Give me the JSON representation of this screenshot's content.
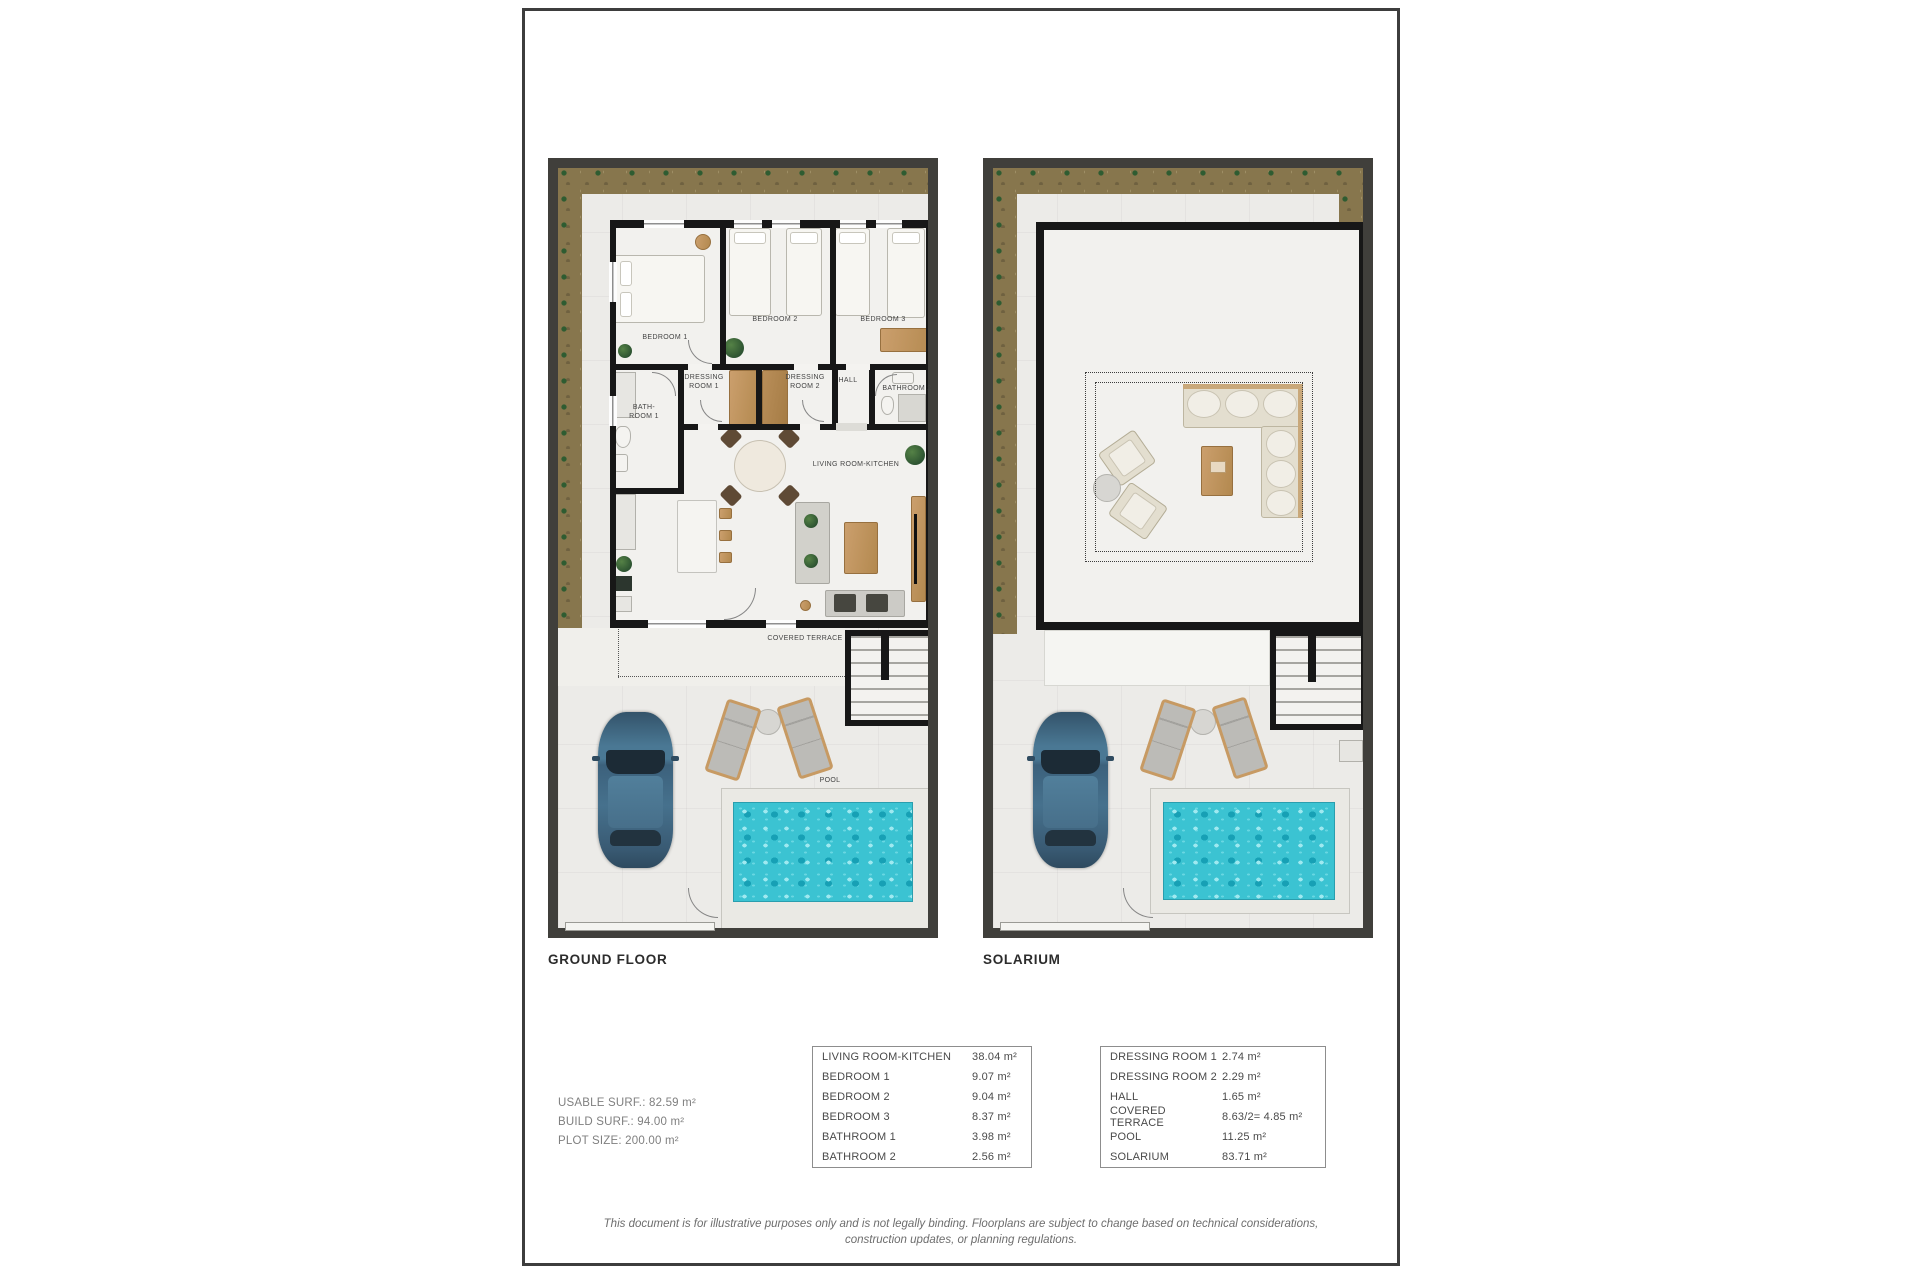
{
  "plans": [
    {
      "title": "GROUND FLOOR",
      "labels": {
        "bedroom1": "BEDROOM 1",
        "bedroom2": "BEDROOM 2",
        "bedroom3": "BEDROOM 3",
        "dressing1": "DRESSING\nROOM 1",
        "dressing2": "DRESSING\nROOM 2",
        "hall": "HALL",
        "bathroom1": "BATH-\nROOM 1",
        "bathroom2": "BATHROOM 2",
        "living": "LIVING ROOM-KITCHEN",
        "terrace": "COVERED TERRACE",
        "pool": "POOL"
      }
    },
    {
      "title": "SOLARIUM"
    }
  ],
  "summary": {
    "usable": "USABLE SURF.: 82.59 m²",
    "build": "BUILD SURF.: 94.00 m²",
    "plot": "PLOT SIZE: 200.00 m²"
  },
  "area_tables": [
    {
      "rows": [
        {
          "label": "LIVING ROOM-KITCHEN",
          "value": "38.04 m²"
        },
        {
          "label": "BEDROOM 1",
          "value": "9.07 m²"
        },
        {
          "label": "BEDROOM 2",
          "value": "9.04 m²"
        },
        {
          "label": "BEDROOM 3",
          "value": "8.37 m²"
        },
        {
          "label": "BATHROOM 1",
          "value": "3.98 m²"
        },
        {
          "label": "BATHROOM 2",
          "value": "2.56 m²"
        }
      ]
    },
    {
      "rows": [
        {
          "label": "DRESSING ROOM 1",
          "value": "2.74 m²"
        },
        {
          "label": "DRESSING ROOM 2",
          "value": "2.29 m²"
        },
        {
          "label": "HALL",
          "value": "1.65 m²"
        },
        {
          "label": "COVERED TERRACE",
          "value": "8.63/2= 4.85 m²"
        },
        {
          "label": "POOL",
          "value": "11.25 m²"
        },
        {
          "label": "SOLARIUM",
          "value": "83.71 m²"
        }
      ]
    }
  ],
  "disclaimer": "This document is for illustrative purposes only and is not legally binding. Floorplans are subject to change based on technical considerations, construction updates, or planning regulations."
}
